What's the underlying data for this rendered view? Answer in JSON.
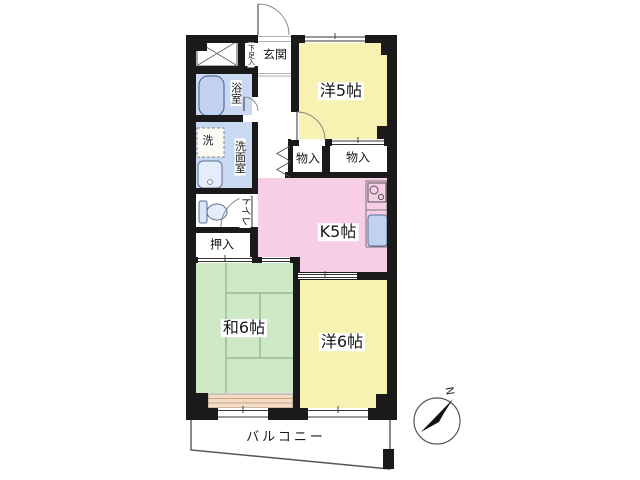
{
  "floor_plan": {
    "labels": {
      "entrance": "玄関",
      "shoe_cabinet": "下足入",
      "western_room_5": "洋5帖",
      "bathroom": "浴室",
      "laundry": "洗",
      "washroom": "洗面室",
      "toilet": "トイレ",
      "futon_closet": "押入",
      "storage_1": "物入",
      "storage_2": "物入",
      "kitchen": "K5帖",
      "japanese_room_6": "和6帖",
      "western_room_6": "洋6帖",
      "balcony": "バルコニー",
      "compass_north": "N"
    },
    "colors": {
      "wall": "#1a1a1a",
      "room_yellow": "#f8f2b2",
      "room_pink": "#f8cde6",
      "room_green": "#cfe9c6",
      "room_blue": "#c9d9f2",
      "strip_peach": "#f6dcc2",
      "fixture_blue": "#c0d2f0",
      "fixture_light_blue": "#e6edfa"
    }
  }
}
